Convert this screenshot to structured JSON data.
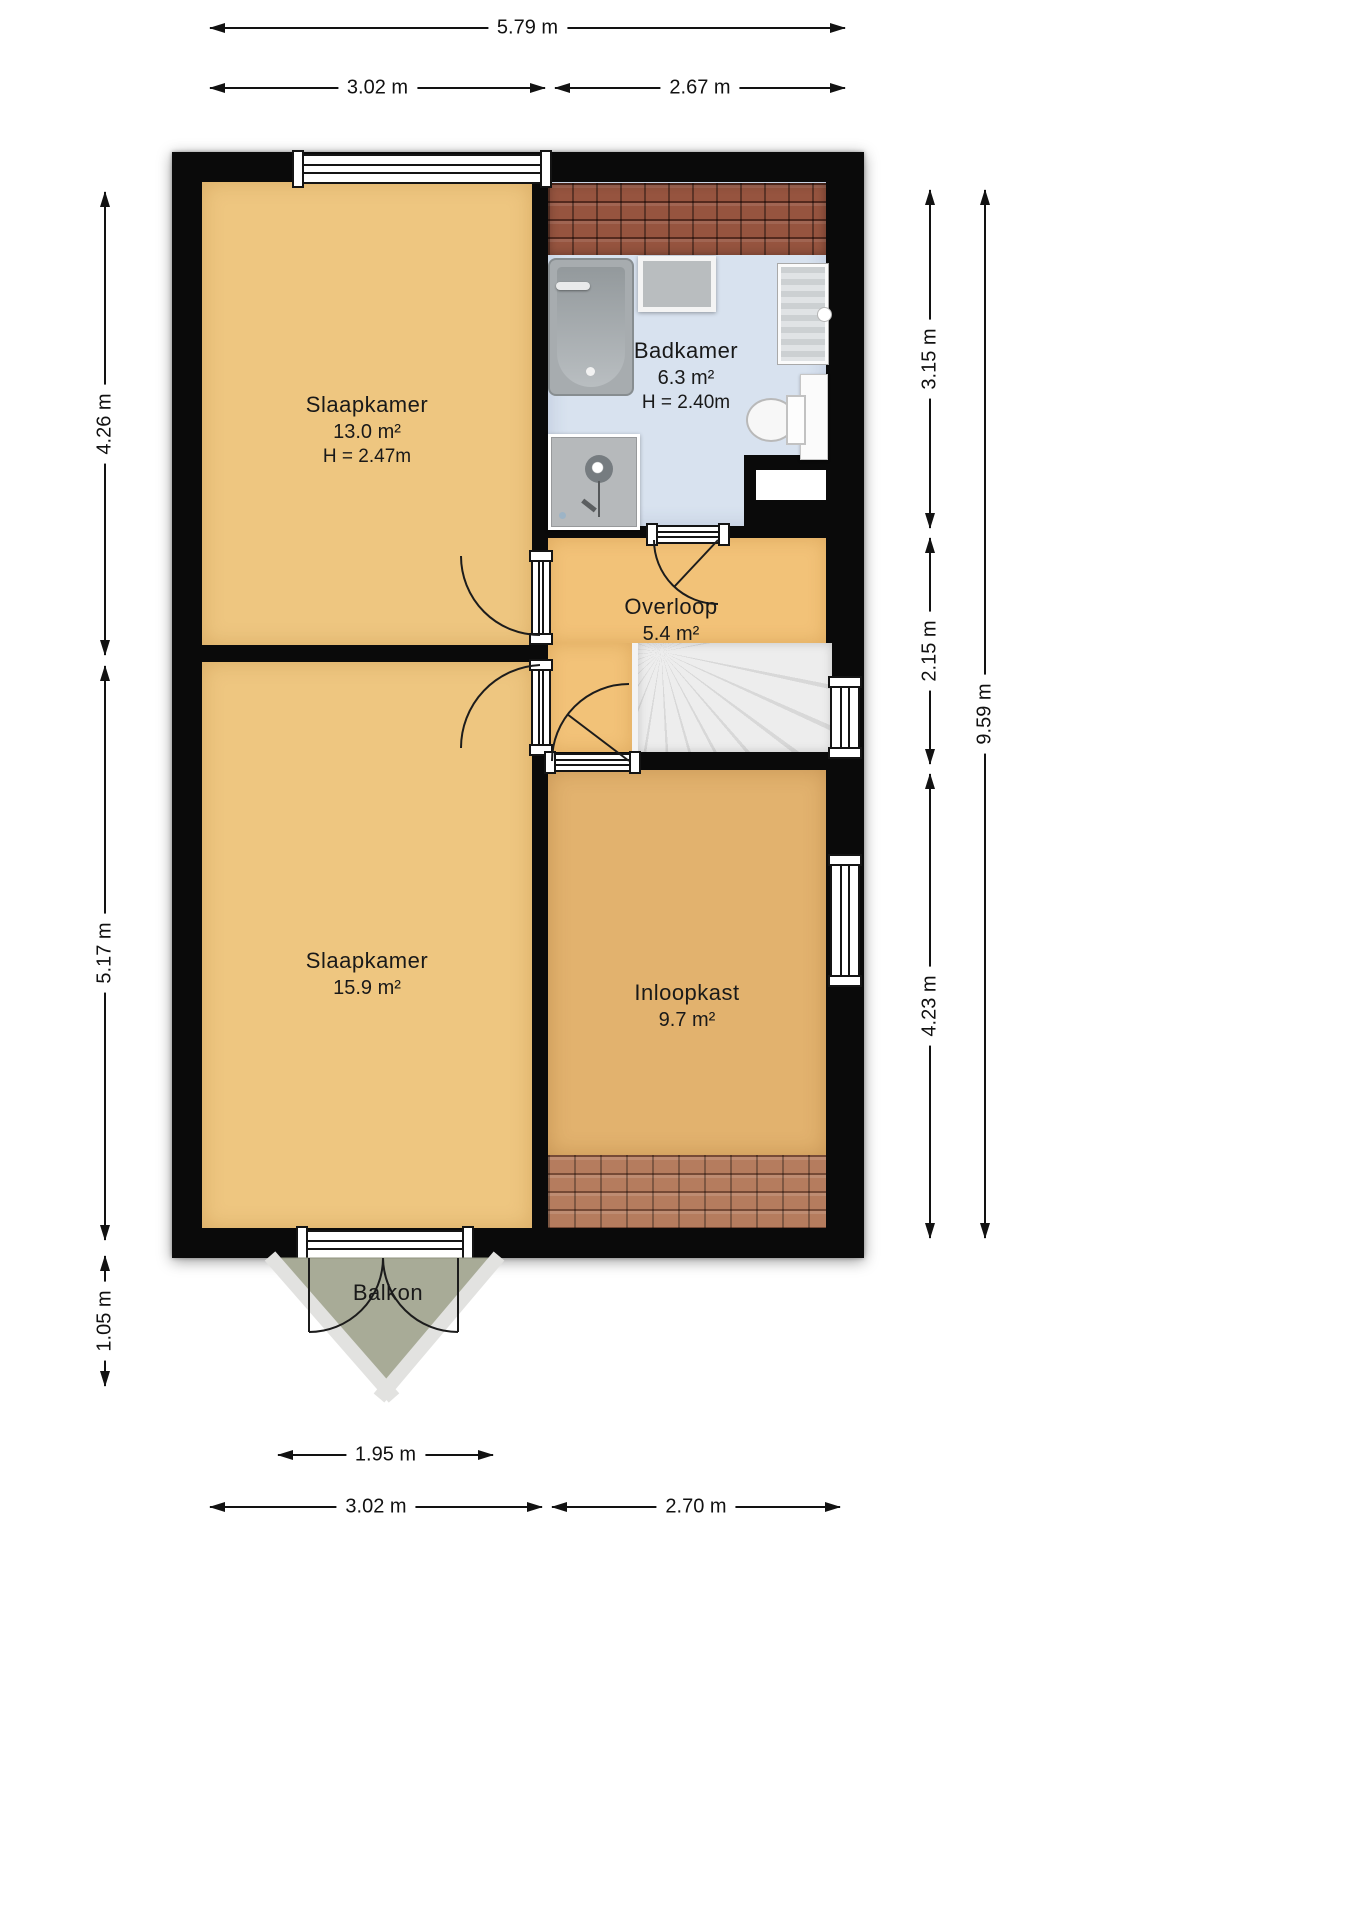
{
  "rooms": [
    {
      "name": "Slaapkamer",
      "area": "13.0 m²",
      "height": "H = 2.47m"
    },
    {
      "name": "Badkamer",
      "area": "6.3 m²",
      "height": "H = 2.40m"
    },
    {
      "name": "Overloop",
      "area": "5.4 m²"
    },
    {
      "name": "Slaapkamer",
      "area": "15.9 m²"
    },
    {
      "name": "Inloopkast",
      "area": "9.7 m²"
    },
    {
      "name": "Balkon"
    }
  ],
  "dimensions": {
    "top": [
      "5.79 m",
      "3.02 m",
      "2.67 m"
    ],
    "left": [
      "4.26 m",
      "5.17 m",
      "1.05 m"
    ],
    "right": [
      "3.15 m",
      "2.15 m",
      "4.23 m",
      "9.59 m"
    ],
    "bottom": [
      "1.95 m",
      "3.02 m",
      "2.70 m"
    ]
  },
  "colors": {
    "wall": "#0a0a0a",
    "bedroom_floor": "#eec680",
    "bathroom_floor": "#d8e2ef",
    "landing_floor": "#f2c278",
    "closet_floor": "#e2b26e",
    "balcony": "#a8ab97",
    "roof_tiles_top": "#96543f",
    "roof_tiles_bottom": "#b57c5e",
    "stairs": "#ececec"
  }
}
